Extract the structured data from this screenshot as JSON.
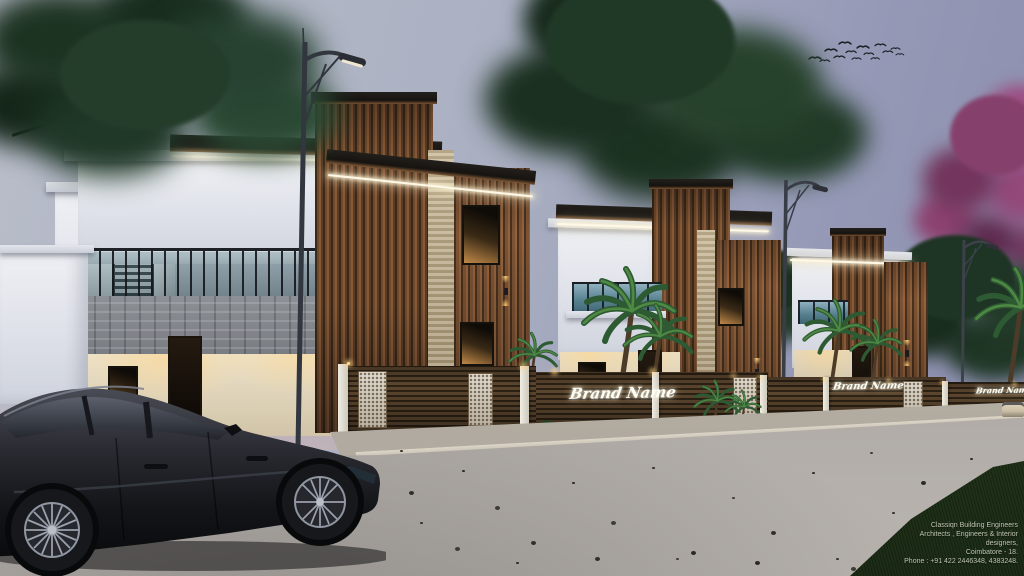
{
  "scene": {
    "type": "architectural-render",
    "description": "Dusk exterior 3D rendering of three modern white-and-wood duplex villas with lit balconies, compound wall gates, street lamps, palms, a flowering tree, birds, and a charcoal sedan parked on the road",
    "sign_text": "Brand Name",
    "watermark": {
      "line1": "Classiqn Building Engineers",
      "line2": "Architects , Engineers & Interior designers,",
      "line3": "Coimbatore - 18.",
      "line4": "Phone : +91 422 2446348, 4383248."
    },
    "colors": {
      "sky_left": "#b9bdc9",
      "sky_right": "#8a8dac",
      "horizon_pink": "#c7b0b6",
      "wood_cladding": "#7a5436",
      "white_wall": "#e6e8ee",
      "grey_stone": "#787c82",
      "beige_stone": "#bfae8c",
      "warm_light": "#ffd98f",
      "glass_balcony": "#5d8595",
      "road": "#aca7a2",
      "grass": "#27391f",
      "foliage": "#2c4a30",
      "flowering_tree": "#8e4472",
      "car_body": "#1d1e24"
    }
  }
}
